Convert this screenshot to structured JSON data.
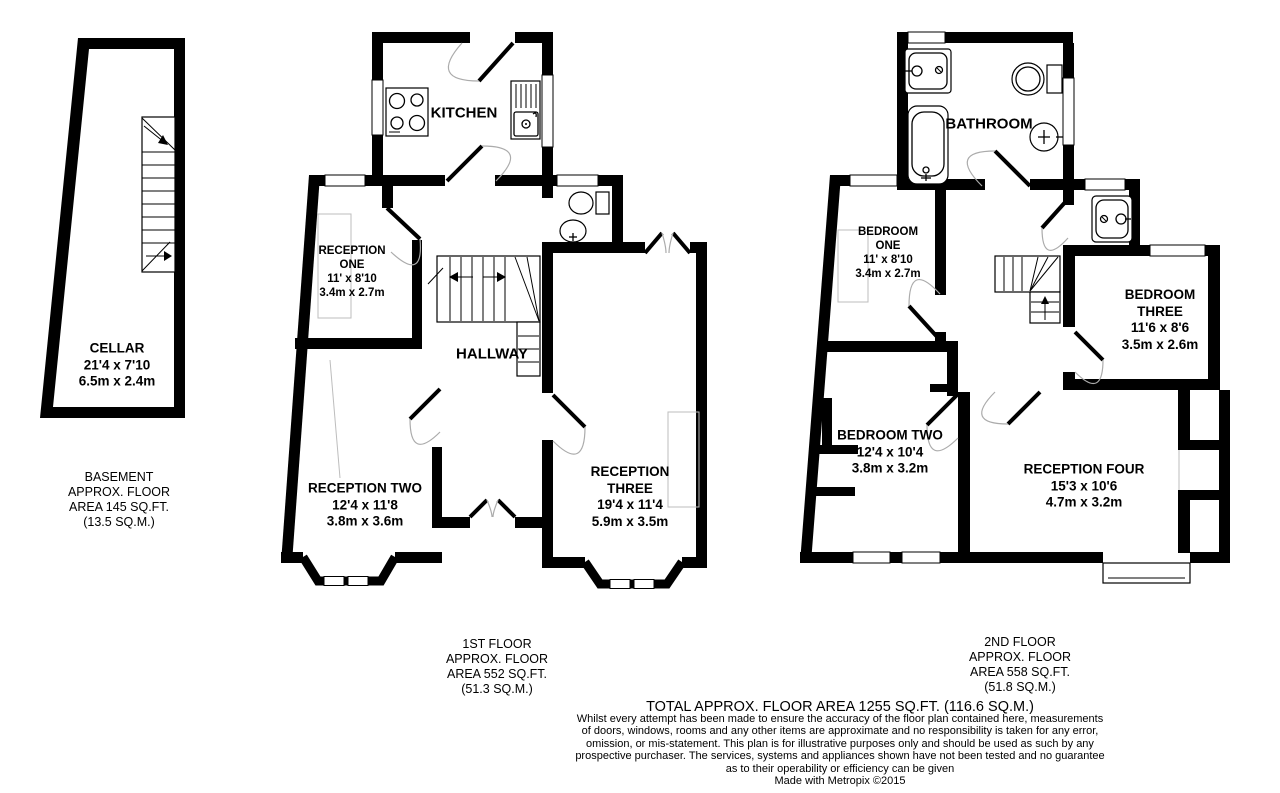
{
  "page": {
    "background": "#ffffff",
    "wall_color": "#000000",
    "door_arc_color": "#ababab",
    "furniture_color": "#bdbdbd"
  },
  "rooms": {
    "cellar": {
      "label": "CELLAR\n21'4 x 7'10\n6.5m x 2.4m"
    },
    "kitchen": {
      "label": "KITCHEN"
    },
    "reception_one": {
      "label": "RECEPTION\nONE\n11' x 8'10\n3.4m x 2.7m"
    },
    "hallway": {
      "label": "HALLWAY"
    },
    "reception_two": {
      "label": "RECEPTION TWO\n12'4 x 11'8\n3.8m x 3.6m"
    },
    "reception_three": {
      "label": "RECEPTION\nTHREE\n19'4 x 11'4\n5.9m x 3.5m"
    },
    "bathroom": {
      "label": "BATHROOM"
    },
    "bedroom_one": {
      "label": "BEDROOM\nONE\n11' x 8'10\n3.4m x 2.7m"
    },
    "bedroom_two": {
      "label": "BEDROOM TWO\n12'4 x 10'4\n3.8m x 3.2m"
    },
    "bedroom_three": {
      "label": "BEDROOM\nTHREE\n11'6 x 8'6\n3.5m x 2.6m"
    },
    "reception_four": {
      "label": "RECEPTION FOUR\n15'3 x 10'6\n4.7m x 3.2m"
    }
  },
  "floor_labels": {
    "basement": "BASEMENT\nAPPROX. FLOOR\nAREA 145 SQ.FT.\n(13.5 SQ.M.)",
    "first": "1ST FLOOR\nAPPROX. FLOOR\nAREA 552 SQ.FT.\n(51.3 SQ.M.)",
    "second": "2ND FLOOR\nAPPROX. FLOOR\nAREA 558 SQ.FT.\n(51.8 SQ.M.)"
  },
  "footer": {
    "total": "TOTAL APPROX. FLOOR AREA 1255 SQ.FT. (116.6 SQ.M.)",
    "disclaimer": "Whilst every attempt has been made to ensure the accuracy of the floor plan contained here, measurements\nof doors, windows, rooms and any other items are approximate and no responsibility is taken for any error,\nomission, or mis-statement. This plan is for illustrative purposes only and should be used as such by any\nprospective purchaser. The services, systems and appliances shown have not been tested and no guarantee\nas to their operability or efficiency can be given",
    "credit": "Made with Metropix ©2015"
  }
}
